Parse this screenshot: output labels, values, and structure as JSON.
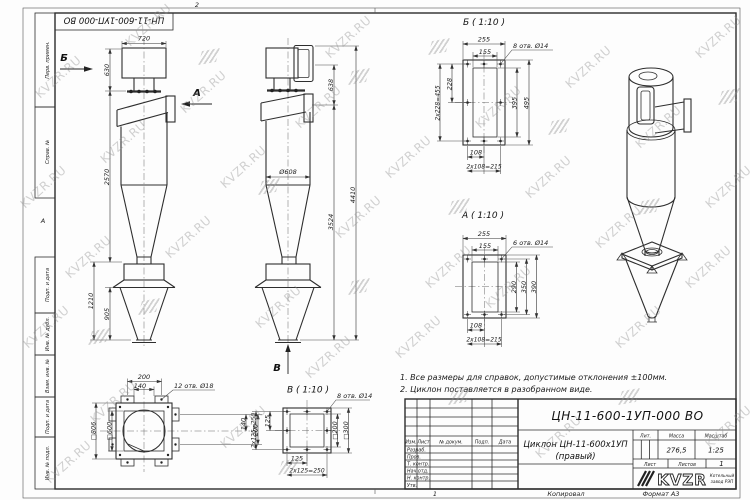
{
  "sheet": {
    "stamp_top": "ЦН-11-600-1УП-000 ВО",
    "zone_top": "2",
    "zone_left": "А",
    "copy_number": "1",
    "footer_copied": "Копировал",
    "footer_format": "Формат А3"
  },
  "margin_fields": [
    "Перв. примен.",
    "Справ. №",
    "Подп. и дата",
    "Инв. № дубл.",
    "Взам. инв. №",
    "Подп. и дата",
    "Инв. № подл."
  ],
  "watermark": {
    "text": "KVZR.RU"
  },
  "notes": {
    "line1": "1. Все размеры для справок, допустимые отклонения ±100мм.",
    "line2": "2. Циклон поставляется в разобранном виде."
  },
  "views": {
    "front": {
      "arrows": {
        "a": "А",
        "b": "Б"
      },
      "dims": {
        "w720": "720",
        "h630": "630",
        "h2570": "2570",
        "h1210": "1210",
        "h905": "905"
      }
    },
    "side": {
      "arrow_v": "В",
      "dims": {
        "h638": "638",
        "d608": "Ø608",
        "h3524": "3524",
        "h4410": "4410"
      }
    },
    "section_b": {
      "title": "Б ( 1:10 )",
      "holes": "8 отв. Ø14",
      "dims": {
        "w255": "255",
        "w155": "155",
        "h228": "228",
        "h455": "2x228=455",
        "h395": "395",
        "h495": "495",
        "w108": "108",
        "w215": "2x108=215"
      }
    },
    "section_a": {
      "title": "А ( 1:10 )",
      "holes": "6 отв. Ø14",
      "dims": {
        "w255": "255",
        "w155": "155",
        "h290": "290",
        "h350": "350",
        "h390": "390",
        "w108": "108",
        "w215": "2x108=215"
      }
    },
    "view_v": {
      "title": "В ( 1:10 )",
      "holes": "8 отв. Ø14",
      "dims": {
        "s200": "□200",
        "s300": "□300",
        "w125": "125",
        "w250": "2x125=250",
        "h125": "125",
        "h250": "2x125=250"
      }
    },
    "base": {
      "holes": "12 отв. Ø18",
      "dims": {
        "w200": "200",
        "w140": "140",
        "s806": "□806",
        "s600": "□600",
        "h140": "140",
        "h200": "200"
      }
    }
  },
  "title_block": {
    "doc_number": "ЦН-11-600-1УП-000 ВО",
    "product_name_1": "Циклон ЦН-11-600х1УП",
    "product_name_2": "(правый)",
    "col_headers": [
      "Изм.",
      "Лист",
      "№ докум.",
      "Подп.",
      "Дата"
    ],
    "row_labels": [
      "Разраб.",
      "Пров.",
      "Т. контр.",
      "Нач.отд.",
      "Н. контр.",
      "Утв."
    ],
    "lit_label": "Лит.",
    "mass_label": "Масса",
    "mass_value": "276,5",
    "scale_label": "Масштаб",
    "scale_value": "1:25",
    "sheet_label": "Лист",
    "sheets_label": "Листов",
    "sheets_value": "1",
    "logo_text": "KVZR",
    "company_line1": "Котельный",
    "company_line2": "завод РЭП"
  }
}
